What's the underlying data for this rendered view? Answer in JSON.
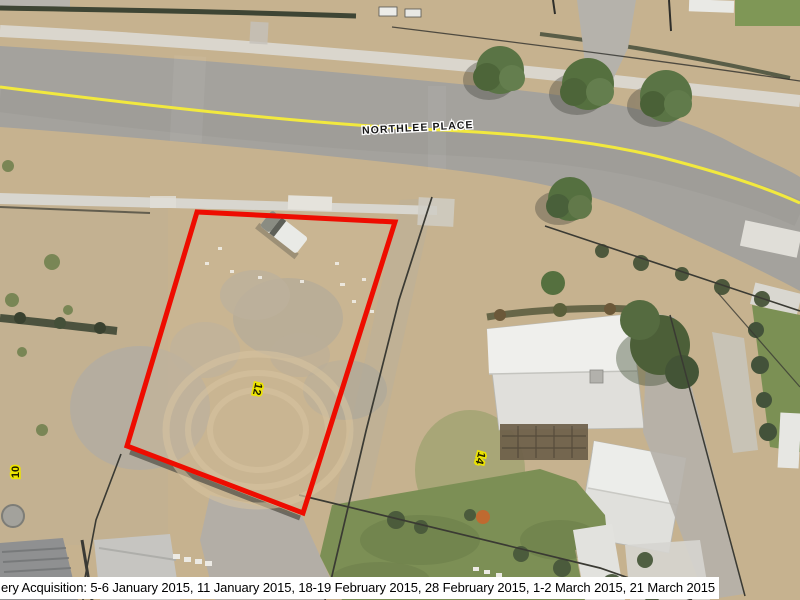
{
  "map": {
    "type": "aerial-imagery-with-cadastral-overlay",
    "street_label": "NORTHLEE PLACE",
    "lot_labels": [
      {
        "text": "10"
      },
      {
        "text": "12"
      },
      {
        "text": "14"
      }
    ],
    "highlighted_parcel": {
      "lot": "12"
    },
    "footer_text": "ery Acquisition: 5-6 January 2015, 11 January 2015, 18-19 February 2015, 28 February 2015, 1-2 March 2015, 21 March 2015",
    "colors": {
      "parcel_boundary": "#ee0c00",
      "road_centerline": "#f2e93e",
      "lot_label_halo": "#ece400",
      "road_surface": "#a4a29d",
      "dry_grass": "#c6b28f",
      "green_lawn": "#7c8f55",
      "sidewalk": "#d8d6cf"
    }
  }
}
